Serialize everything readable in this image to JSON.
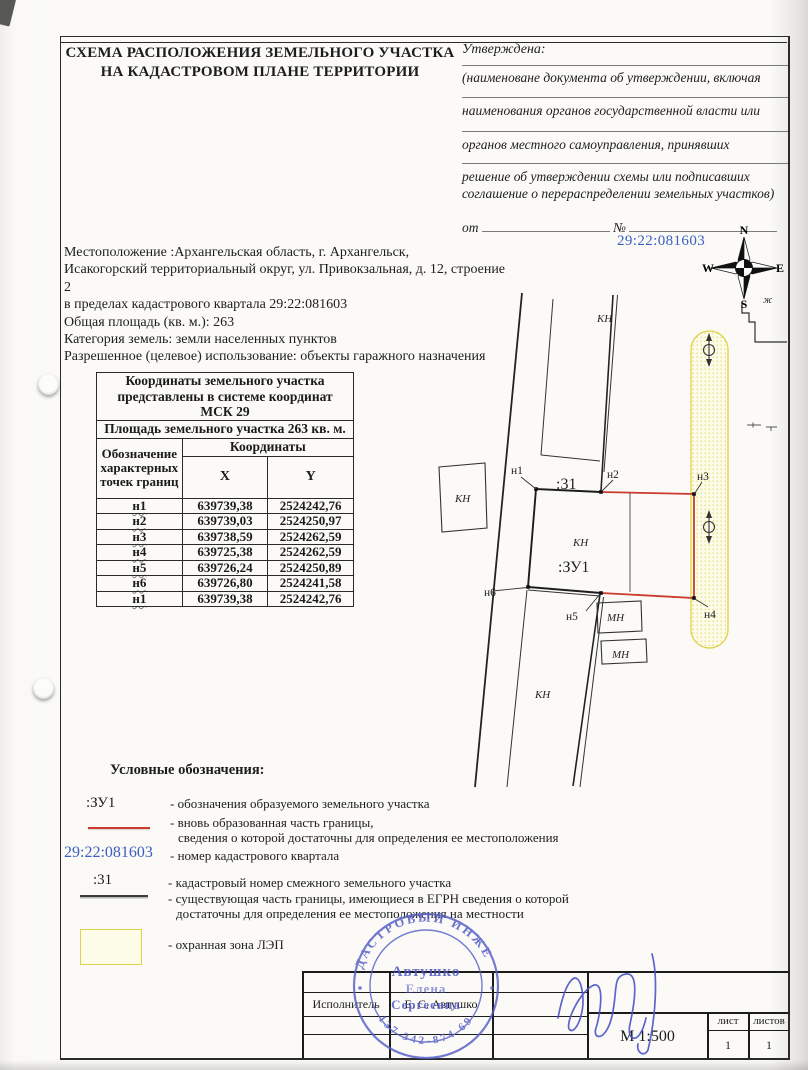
{
  "header": {
    "title_line1": "СХЕМА РАСПОЛОЖЕНИЯ ЗЕМЕЛЬНОГО УЧАСТКА",
    "title_line2": "НА КАДАСТРОВОМ ПЛАНЕ ТЕРРИТОРИИ",
    "approval": {
      "label": "Утверждена:",
      "caption1": "(наименоване документа об утверждении, включая",
      "caption2": "наименования органов государственной власти или",
      "caption3": "органов местного самоуправления, принявших",
      "caption4": "решение об утверждении схемы или подписавших",
      "caption5": "соглашение о перераспределении земельных участков)",
      "from_label": "от",
      "number_label": "№"
    }
  },
  "location": {
    "line1": "Местоположение :Архангельская область, г. Архангельск,",
    "line2": "Исакогорский территориальный округ, ул. Привокзальная, д. 12, строение 2",
    "line3": "в пределах кадастрового квартала 29:22:081603",
    "line4": "Общая площадь (кв. м.): 263",
    "line5": "Категория земель: земли населенных пунктов",
    "line6": "Разрешенное (целевое) использование: объекты гаражного назначения"
  },
  "quarter_number": "29:22:081603",
  "coords_table": {
    "caption_lines": [
      "Координаты земельного участка",
      "представлены в системе координат",
      "МСК 29"
    ],
    "area_row": "Площадь земельного участка  263 кв. м.",
    "col_point": "Обозначение характерных точек границ",
    "col_coords": "Координаты",
    "col_x": "X",
    "col_y": "Y",
    "rows": [
      {
        "p": "н1",
        "x": "639739,38",
        "y": "2524242,76"
      },
      {
        "p": "н2",
        "x": "639739,03",
        "y": "2524250,97"
      },
      {
        "p": "н3",
        "x": "639738,59",
        "y": "2524262,59"
      },
      {
        "p": "н4",
        "x": "639725,38",
        "y": "2524262,59"
      },
      {
        "p": "н5",
        "x": "639726,24",
        "y": "2524250,89"
      },
      {
        "p": "н6",
        "x": "639726,80",
        "y": "2524241,58"
      },
      {
        "p": "н1",
        "x": "639739,38",
        "y": "2524242,76"
      }
    ]
  },
  "map": {
    "labels": [
      {
        "t": "КН"
      },
      {
        "t": "КН"
      },
      {
        "t": "н1"
      },
      {
        "t": ":31"
      },
      {
        "t": "н2"
      },
      {
        "t": "н3"
      },
      {
        "t": "КН"
      },
      {
        "t": ":ЗУ1"
      },
      {
        "t": "н6"
      },
      {
        "t": "н5"
      },
      {
        "t": "н4"
      },
      {
        "t": "МН"
      },
      {
        "t": "МН"
      },
      {
        "t": "КН"
      },
      {
        "t": "ж"
      }
    ],
    "compass": {
      "n": "N",
      "w": "W",
      "e": "E",
      "s": "S"
    },
    "colors": {
      "boundary_new": "#cc3a30",
      "zone_border": "#e0d049",
      "quarter_blue": "#3a5fc0"
    }
  },
  "legend": {
    "heading": "Условные обозначения:",
    "item1_symbol": ":ЗУ1",
    "item1_desc": "- обозначения образуемого  земельного участка",
    "item2_desc1": "- вновь образованная часть границы,",
    "item2_desc2": "сведения о которой достаточны для определения ее местоположения",
    "item3_symbol": "29:22:081603",
    "item3_desc": "- номер кадастрового квартала",
    "item4_symbol": ":31",
    "item4_desc": "- кадастровый номер смежного земельного участка",
    "item5_desc1": "- существующая часть границы, имеющиеся в ЕГРН сведения о которой",
    "item5_desc2": "достаточны для определения ее местоположения на местности",
    "item6_desc": "- охранная зона ЛЭП"
  },
  "title_block": {
    "executor_label": "Исполнитель",
    "executor_name": "Е. С. Автушко",
    "scale": "М 1:500",
    "sheet_label": "лист",
    "sheets_label": "листов",
    "sheet_value": "1",
    "sheets_value": "1"
  },
  "stamp": {
    "ring_top": "КАДАСТРОВЫЙ  ИНЖЕНЕР",
    "ring_bottom": "137 342-874 69",
    "name1": "Автушко",
    "name2": "Елена",
    "name3": "Сергеевна"
  }
}
